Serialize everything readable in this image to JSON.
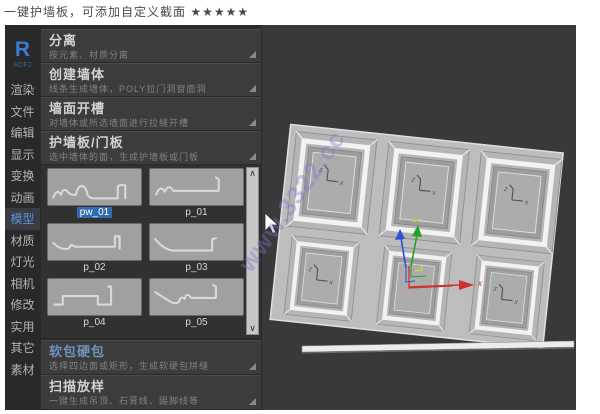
{
  "page": {
    "title": "一键护墙板，可添加自定义截面 ★★★★★"
  },
  "sidebar": {
    "logo": "R",
    "logo_sub": "RDF2",
    "tabs": [
      "渲染",
      "文件",
      "编辑",
      "显示",
      "变换",
      "动画",
      "模型",
      "材质",
      "灯光",
      "相机",
      "修改",
      "实用",
      "其它",
      "素材"
    ],
    "active_tab": "模型"
  },
  "panel": {
    "sections": [
      {
        "title": "分离",
        "subtitle": "按元素、材质分离"
      },
      {
        "title": "创建墙体",
        "subtitle": "线条生成墙体，POLY拉门洞窗面洞"
      },
      {
        "title": "墙面开槽",
        "subtitle": "对墙体或所选墙面进行拉缝开槽"
      },
      {
        "title": "护墙板/门板",
        "subtitle": "选中墙体的面，生成护墙板或门板"
      },
      {
        "title": "软包硬包",
        "subtitle": "选择四边面或矩形，生成软硬包拼缝"
      },
      {
        "title": "扫描放样",
        "subtitle": "一键生成吊顶、石膏线、踢脚线等"
      }
    ],
    "profiles": [
      {
        "label": "pw_01",
        "selected": true
      },
      {
        "label": "p_01",
        "selected": false
      },
      {
        "label": "p_02",
        "selected": false
      },
      {
        "label": "p_03",
        "selected": false
      },
      {
        "label": "p_04",
        "selected": false
      },
      {
        "label": "p_05",
        "selected": false
      }
    ]
  },
  "icons": {
    "scroll_up": "∧",
    "scroll_down": "∨"
  },
  "viewport": {
    "watermark": "www.3322.cc",
    "axis_z": "z",
    "axis_x": "x",
    "gizmo_x": "x"
  },
  "colors": {
    "accent_blue": "#5b93d8",
    "section_title": "#d2d2d2",
    "soft_pack_title": "#6f93c0",
    "selected_label_bg": "#2f6cb0",
    "viewport_bg": "#39393b",
    "gizmo_red": "#d03030",
    "gizmo_green": "#22a422",
    "gizmo_blue": "#2b50d8",
    "gizmo_yellow": "#d6d630",
    "watermark": "rgba(125,115,205,0.38)"
  }
}
